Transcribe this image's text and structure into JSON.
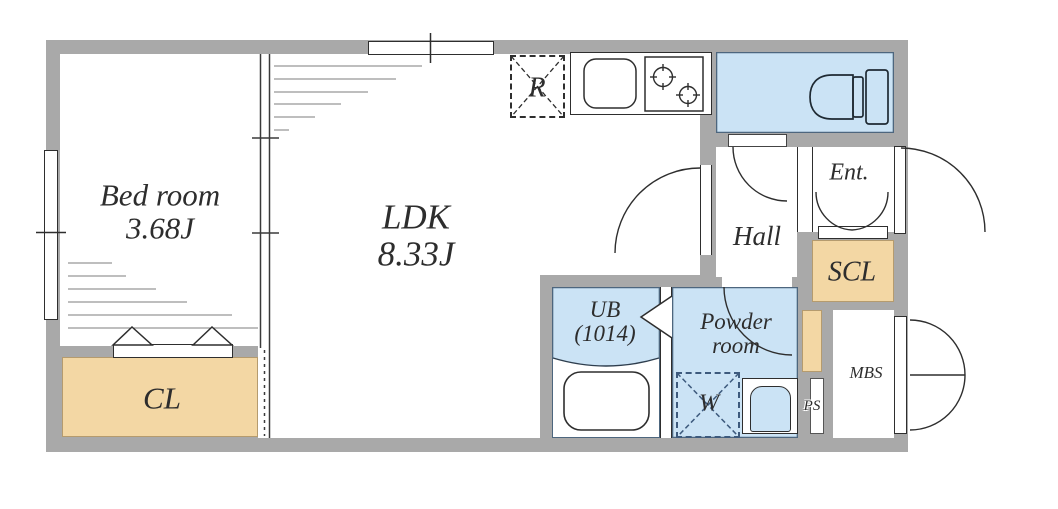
{
  "colors": {
    "background": "#ffffff",
    "wall": "#a9a9a9",
    "water_room": "#cbe3f5",
    "storage": "#f3d7a4",
    "line": "#2e2e2e"
  },
  "rooms": {
    "bedroom": {
      "name": "Bed room",
      "area": "3.68J"
    },
    "ldk": {
      "name": "LDK",
      "area": "8.33J"
    },
    "closet": {
      "label": "CL"
    },
    "unit_bath": {
      "label": "UB",
      "size": "(1014)"
    },
    "powder_room": {
      "line1": "Powder",
      "line2": "room"
    },
    "hall": {
      "label": "Hall"
    },
    "entrance": {
      "label": "Ent."
    },
    "shoe_closet": {
      "label": "SCL"
    }
  },
  "fixtures": {
    "refrigerator": {
      "label": "R"
    },
    "washer": {
      "label": "W"
    }
  },
  "utilities": {
    "pipe_space": {
      "label": "PS"
    },
    "meter_box": {
      "label": "MBS"
    }
  }
}
